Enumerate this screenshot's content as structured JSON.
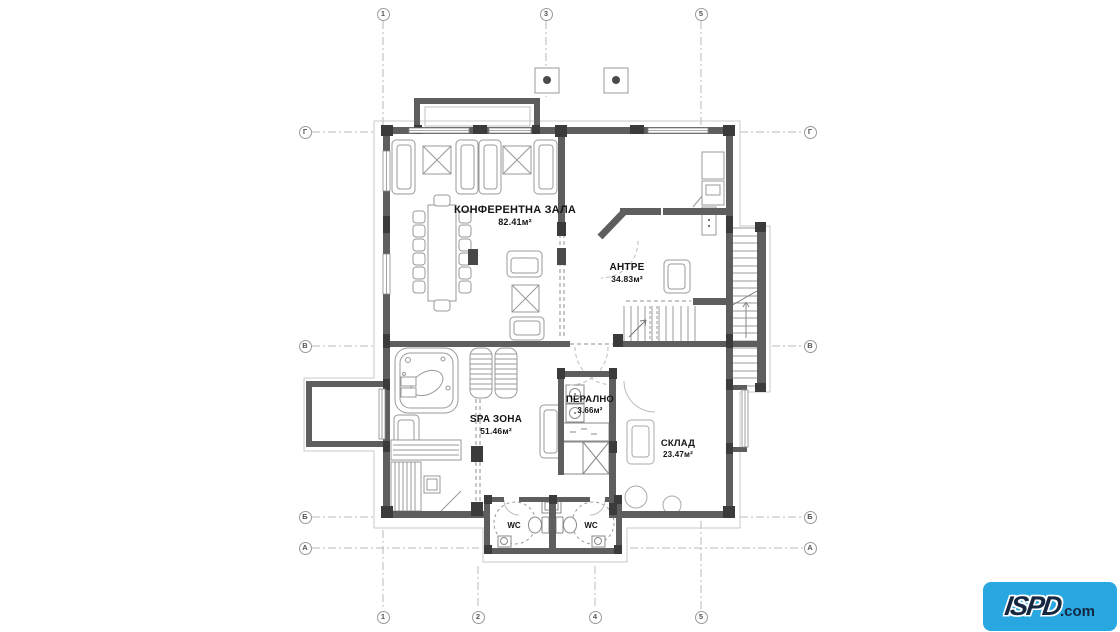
{
  "grid": {
    "top": [
      "1",
      "3",
      "5"
    ],
    "bottom": [
      "1",
      "2",
      "4",
      "5"
    ],
    "left": [
      "Г",
      "В",
      "Б",
      "А"
    ],
    "right": [
      "Г",
      "В",
      "Б",
      "А"
    ]
  },
  "rooms": {
    "conference": {
      "name": "КОНФЕРЕНТНА ЗАЛА",
      "area": "82.41м²"
    },
    "antre": {
      "name": "АНТРЕ",
      "area": "34.83м²"
    },
    "spa": {
      "name": "SPA ЗОНА",
      "area": "51.46м²"
    },
    "laundry": {
      "name": "ПЕРАЛНО",
      "area": "3.66м²"
    },
    "storage": {
      "name": "СКЛАД",
      "area": "23.47м²"
    },
    "wc_left": {
      "name": "WC"
    },
    "wc_right": {
      "name": "WC"
    }
  },
  "logo": {
    "text": "ISPD",
    "tld": ".com",
    "bg_color": "#29a7e0",
    "text_color": "#152741"
  },
  "colors": {
    "wall": "#5e5e5e",
    "column": "#3b3b3b",
    "furniture": "#999999",
    "grid_line": "#b8b8b8"
  }
}
